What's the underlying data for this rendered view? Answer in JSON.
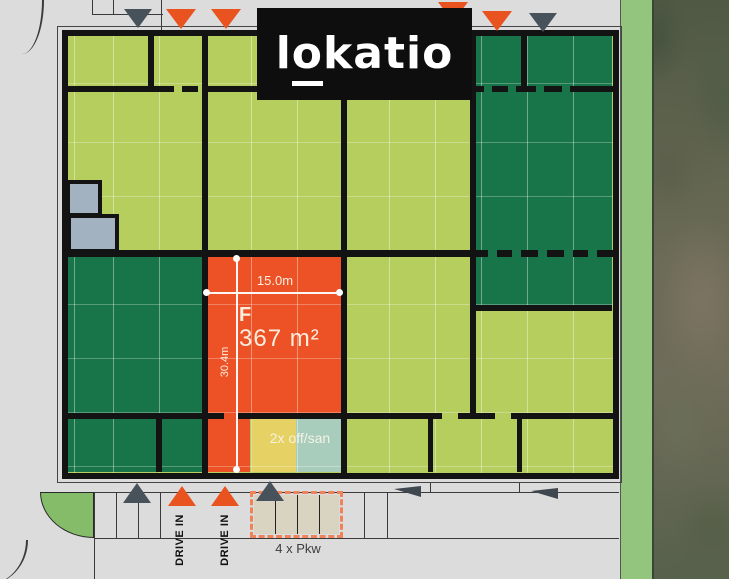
{
  "brand": {
    "logo_l": "l",
    "logo_o": "o",
    "logo_rest": "katio"
  },
  "unit_f": {
    "code": "F",
    "area": "367 m²",
    "width_label": "15.0m",
    "depth_label": "30.4m",
    "office_label": "2x off/san"
  },
  "site": {
    "drive_in_labels": [
      "DRIVE IN",
      "DRIVE IN"
    ],
    "parking_label": "4 x Pkw"
  },
  "colors": {
    "highlight_orange": "#EC5226",
    "unit_light_green": "#B6CE5E",
    "unit_dark_green": "#187449",
    "office_yellow": "#E5D164",
    "sanitary_teal": "#A9CDBC",
    "stairs_gray": "#A3B2C0",
    "parking_beige": "#D9D3C2",
    "arrow_gray": "#47525A",
    "arrow_orange": "#E8531F",
    "background": "#DCDCDC"
  }
}
